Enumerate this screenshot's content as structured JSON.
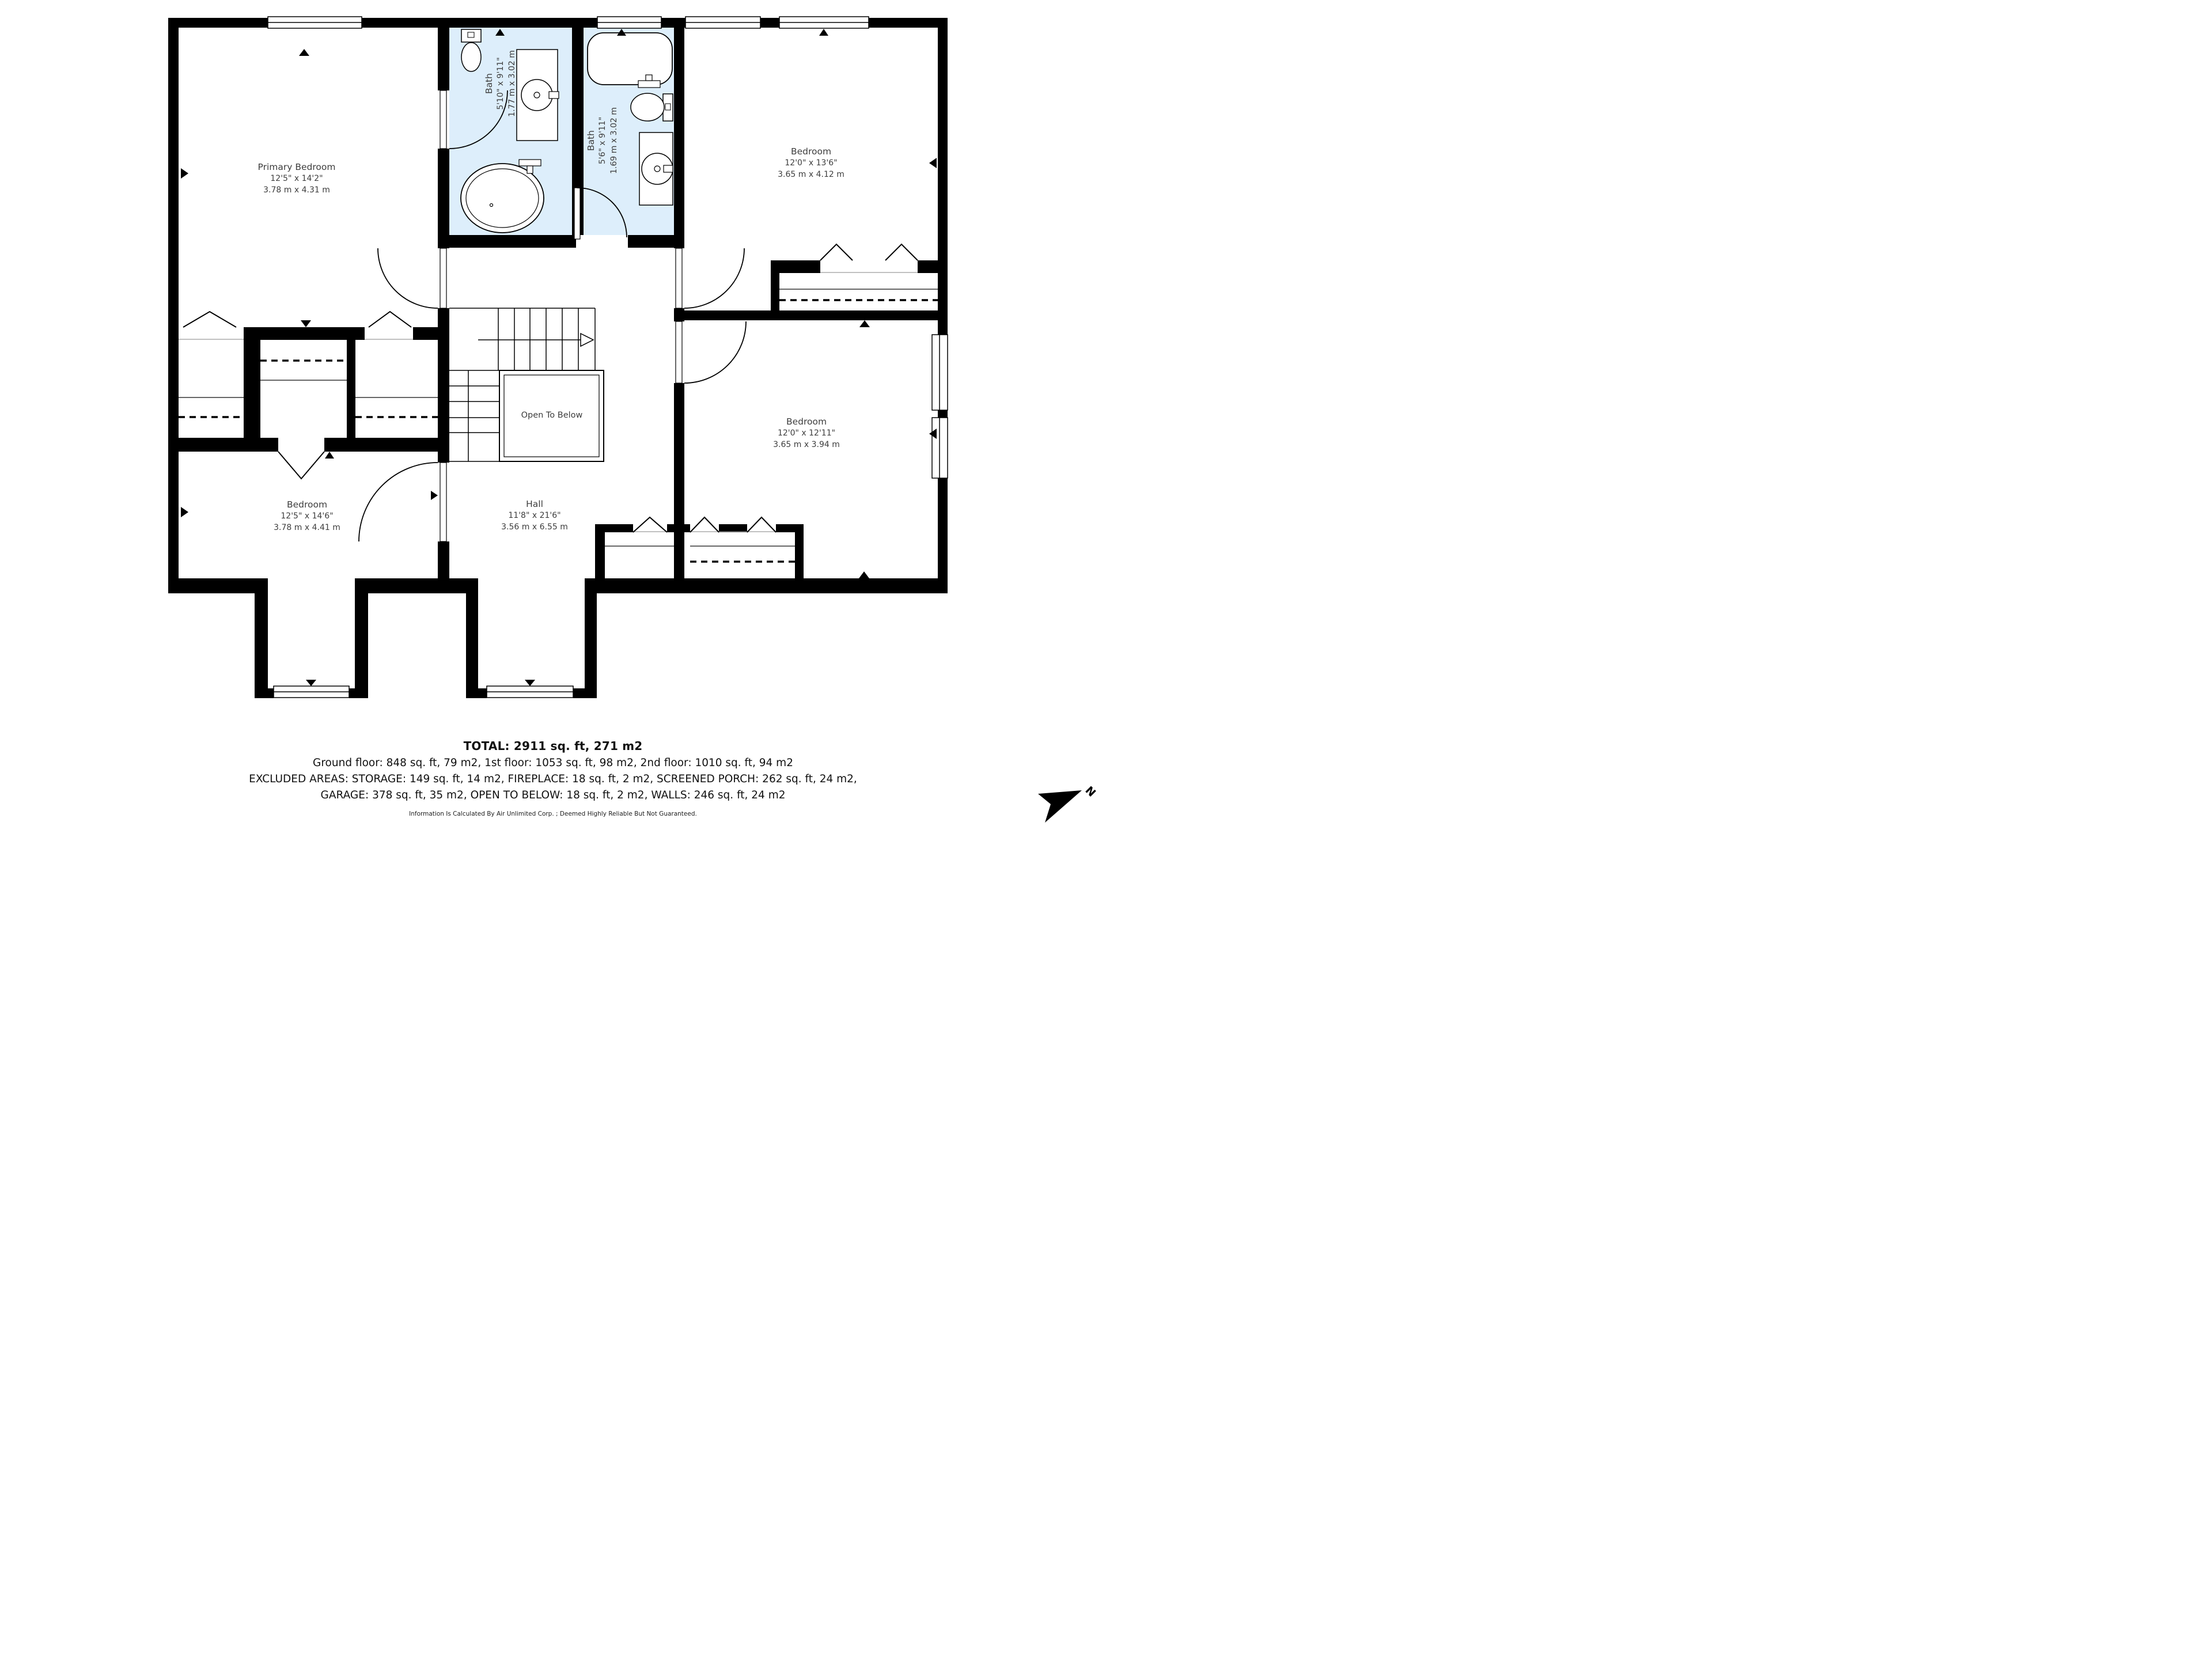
{
  "rooms": {
    "primary_bedroom": {
      "name": "Primary Bedroom",
      "imperial": "12'5\" x 14'2\"",
      "metric": "3.78 m x 4.31 m"
    },
    "bath_1": {
      "name": "Bath",
      "imperial": "5'10\" x 9'11\"",
      "metric": "1.77 m x 3.02 m"
    },
    "bath_2": {
      "name": "Bath",
      "imperial": "5'6\" x 9'11\"",
      "metric": "1.69 m x 3.02 m"
    },
    "bedroom_top_right": {
      "name": "Bedroom",
      "imperial": "12'0\" x 13'6\"",
      "metric": "3.65 m x 4.12 m"
    },
    "bedroom_right": {
      "name": "Bedroom",
      "imperial": "12'0\" x 12'11\"",
      "metric": "3.65 m x 3.94 m"
    },
    "bedroom_bottom_left": {
      "name": "Bedroom",
      "imperial": "12'5\" x 14'6\"",
      "metric": "3.78 m x 4.41 m"
    },
    "hall": {
      "name": "Hall",
      "imperial": "11'8\" x 21'6\"",
      "metric": "3.56 m x 6.55 m"
    },
    "open_to_below": {
      "label": "Open To Below"
    }
  },
  "footer": {
    "total": "TOTAL: 2911 sq. ft, 271 m2",
    "floors": "Ground floor: 848 sq. ft, 79 m2, 1st floor: 1053 sq. ft, 98 m2, 2nd floor: 1010 sq. ft, 94 m2",
    "excluded_1": "EXCLUDED AREAS: STORAGE: 149 sq. ft, 14 m2, FIREPLACE: 18 sq. ft, 2 m2, SCREENED PORCH: 262 sq. ft, 24 m2,",
    "excluded_2": "GARAGE: 378 sq. ft, 35 m2, OPEN TO BELOW: 18 sq. ft, 2 m2, WALLS: 246 sq. ft, 24 m2",
    "disclaimer": "Information Is Calculated By Air Unlimited Corp. ; Deemed Highly Reliable But Not Guaranteed."
  },
  "compass": {
    "label": "N"
  },
  "colors": {
    "wall": "#000000",
    "bath_fill": "#ddeefb",
    "text": "#3d3d3d"
  }
}
